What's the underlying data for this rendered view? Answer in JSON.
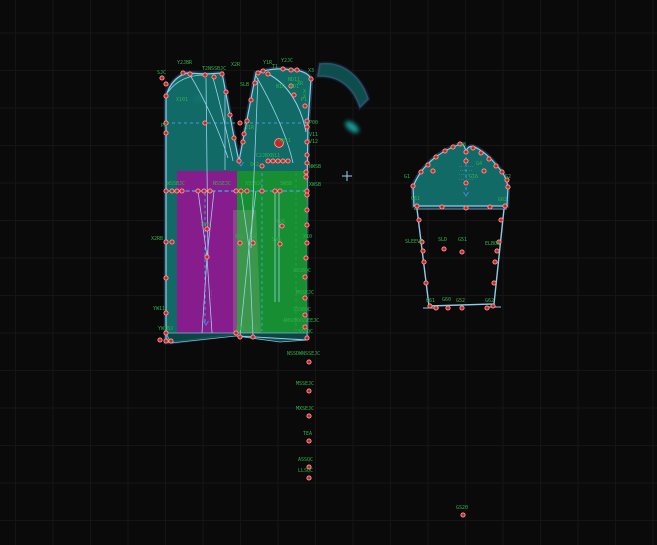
{
  "app": {
    "type": "pattern-drafting-canvas"
  },
  "canvas": {
    "width": 657,
    "height": 545,
    "background": "#0a0a0a",
    "grid": {
      "spacing": 37.5,
      "offset_x": 15.5,
      "offset_y": 33,
      "color": "#151515"
    }
  },
  "colors": {
    "piece_teal": "#12706c",
    "piece_magenta": "#8e188e",
    "piece_green": "#17912c",
    "overlap_sage": "rgba(160,175,150,0.28)",
    "hem_teal": "#0b4240",
    "outline_blue": "#8fcbe8",
    "halo_navy": "#1f3242",
    "dash_cyan": "#3f9fd8",
    "dash_green": "#2a9d44",
    "point_fill": "#c42727",
    "point_ring": "#ff9d9d",
    "label_green": "#2fb24a",
    "arrow_blue": "#4a7fe0",
    "cursor_cyan": "#8fd7f2",
    "glow_teal": "#19c2b8"
  },
  "pieces": [
    {
      "name": "bodice",
      "d": "M166,96 C170,83 177,76 187,73 L206,74 L222,73 C228,103 234,140 239,161 C243,141 250,104 256,73 L263,71 C272,69 282,68 291,70 L297,70 C304,72 309,74 311,79 L308,123 L307,191 L306,280 L307,338 L280,340 L236,334 L171,342 L166,342 Z",
      "fill": "#12706c",
      "opacity": 0.95,
      "stroke": "#8fcbe8",
      "sw": 1.2,
      "halo": "#1f3242"
    },
    {
      "name": "collar-band",
      "d": "M320,64 C343,61 361,77 368,99 L360,107 C353,86 338,75 318,76 Z",
      "fill": "#0d5250",
      "opacity": 0.95,
      "stroke": "#31506b",
      "sw": 1.6,
      "halo": "#101c29"
    },
    {
      "name": "grade-magenta",
      "d": "M177,171 L237,171 L237,333 L177,333 Z",
      "fill": "#8e188e",
      "opacity": 0.95
    },
    {
      "name": "grade-green",
      "d": "M237,171 L307,171 L307,333 L237,333 Z",
      "fill": "#17912c",
      "opacity": 0.92
    },
    {
      "name": "grade-overlap",
      "d": "M233,210 L256,210 L261,333 L233,333 Z",
      "fill": "rgba(160,175,150,0.28)"
    },
    {
      "name": "hem-strip",
      "d": "M166,333 L307,333 L307,340 L280,342 L236,336 L171,343 Z",
      "fill": "#0b4240",
      "opacity": 0.9,
      "stroke": "#7fb8da",
      "sw": 0.8
    },
    {
      "name": "sleeve-cap",
      "d": "M413,187 C417,176 424,167 432,160 C440,153 450,148 458,145 C462,143 464,144 466,151 C469,144 474,146 480,150 C488,155 496,164 502,172 C505,176 507,182 508,187 L507,206 L414,206 Z",
      "fill": "#12706c",
      "opacity": 0.95,
      "stroke": "#8fcbe8",
      "sw": 1.2,
      "halo": "#1f3242"
    },
    {
      "name": "sleeve-body",
      "d": "M417,209 L429,306 L494,304 L504,209",
      "fill": "none",
      "stroke": "#8fcbe8",
      "sw": 1.4
    }
  ],
  "lines": [
    {
      "d": "M166,123 H308",
      "c": "#3f9fd8",
      "w": 1,
      "da": "3,3"
    },
    {
      "d": "M166,191 H307",
      "c": "#3f9fd8",
      "w": 1.6,
      "da": "4,2.5"
    },
    {
      "d": "M205,193 V322",
      "c": "#3f9fd8",
      "w": 1,
      "da": "3,3"
    },
    {
      "d": "M262,173 V331",
      "c": "#3f9fd8",
      "w": 1,
      "da": "3,3"
    },
    {
      "d": "M296,173 V331",
      "c": "#2a9d44",
      "w": 1,
      "da": "3,3"
    },
    {
      "d": "M466,157 V193",
      "c": "#3f9fd8",
      "w": 1,
      "da": "3,3"
    },
    {
      "d": "M225,95 V170",
      "c": "#9ad1ea",
      "w": 0.8
    },
    {
      "d": "M206,78 L208,257",
      "c": "#9ad1ea",
      "w": 0.8
    },
    {
      "d": "M258,78 L251,248",
      "c": "#9ad1ea",
      "w": 0.8
    },
    {
      "d": "M198,191 L207,257",
      "c": "#9ad1ea",
      "w": 0.8
    },
    {
      "d": "M214,191 L207,257",
      "c": "#9ad1ea",
      "w": 0.8
    },
    {
      "d": "M207,257 L202,333",
      "c": "#9ad1ea",
      "w": 0.8
    },
    {
      "d": "M207,257 L212,333",
      "c": "#9ad1ea",
      "w": 0.8
    },
    {
      "d": "M241,191 L249,247",
      "c": "#9ad1ea",
      "w": 0.8
    },
    {
      "d": "M256,191 L249,247",
      "c": "#9ad1ea",
      "w": 0.8
    },
    {
      "d": "M249,247 L240,336",
      "c": "#9ad1ea",
      "w": 0.8
    },
    {
      "d": "M249,247 L253,336",
      "c": "#9ad1ea",
      "w": 0.8
    },
    {
      "d": "M275,191 V302",
      "c": "#9ad1ea",
      "w": 0.8
    },
    {
      "d": "M279,191 V302",
      "c": "#9ad1ea",
      "w": 0.8
    },
    {
      "d": "M268,74 C288,84 301,106 306,132",
      "c": "#9ad1ea",
      "w": 1
    },
    {
      "d": "M256,76 C270,100 287,135 293,163",
      "c": "#9ad1ea",
      "w": 0.8
    },
    {
      "d": "M190,75 C204,98 219,130 228,158",
      "c": "#9ad1ea",
      "w": 0.8
    },
    {
      "d": "M213,78 C221,106 228,138 233,161",
      "c": "#9ad1ea",
      "w": 0.8
    },
    {
      "d": "M168,92 C177,80 190,75 204,75",
      "c": "#9ad1ea",
      "w": 0.8
    },
    {
      "d": "M237,336 L307,340",
      "c": "#9ad1ea",
      "w": 0.9
    },
    {
      "d": "M413,206 H508",
      "c": "#8fcbe8",
      "w": 1.1
    },
    {
      "d": "M414,209 H507",
      "c": "#8fcbe8",
      "w": 0.8
    },
    {
      "d": "M423,308 H439",
      "c": "#8fcbe8",
      "w": 1
    },
    {
      "d": "M485,307 H501",
      "c": "#8fcbe8",
      "w": 1
    }
  ],
  "points": [
    [
      162,
      78
    ],
    [
      166,
      84
    ],
    [
      166,
      96
    ],
    [
      166,
      123
    ],
    [
      166,
      133
    ],
    [
      166,
      191
    ],
    [
      166,
      242
    ],
    [
      166,
      278
    ],
    [
      166,
      313
    ],
    [
      166,
      333
    ],
    [
      166,
      341
    ],
    [
      183,
      73
    ],
    [
      190,
      74
    ],
    [
      205,
      75
    ],
    [
      214,
      77
    ],
    [
      222,
      74
    ],
    [
      258,
      73
    ],
    [
      263,
      71
    ],
    [
      268,
      74
    ],
    [
      283,
      69
    ],
    [
      291,
      70
    ],
    [
      297,
      70
    ],
    [
      311,
      79
    ],
    [
      226,
      92
    ],
    [
      230,
      115
    ],
    [
      234,
      138
    ],
    [
      239,
      161
    ],
    [
      243,
      142
    ],
    [
      247,
      121
    ],
    [
      251,
      100
    ],
    [
      255,
      83
    ],
    [
      291,
      86
    ],
    [
      294,
      95
    ],
    [
      305,
      106
    ],
    [
      307,
      121
    ],
    [
      307,
      127
    ],
    [
      307,
      142
    ],
    [
      307,
      155
    ],
    [
      307,
      163
    ],
    [
      306,
      172
    ],
    [
      306,
      177
    ],
    [
      307,
      195
    ],
    [
      307,
      210
    ],
    [
      307,
      225
    ],
    [
      307,
      243
    ],
    [
      306,
      258
    ],
    [
      305,
      277
    ],
    [
      305,
      298
    ],
    [
      305,
      315
    ],
    [
      305,
      327
    ],
    [
      307,
      338
    ],
    [
      240,
      123
    ],
    [
      205,
      123
    ],
    [
      279,
      143,
      1
    ],
    [
      268,
      161
    ],
    [
      273,
      161
    ],
    [
      278,
      161
    ],
    [
      283,
      161
    ],
    [
      288,
      161
    ],
    [
      262,
      166
    ],
    [
      244,
      134
    ],
    [
      172,
      191
    ],
    [
      177,
      191
    ],
    [
      182,
      191
    ],
    [
      198,
      191
    ],
    [
      204,
      191
    ],
    [
      210,
      191
    ],
    [
      236,
      191
    ],
    [
      241,
      191
    ],
    [
      247,
      191
    ],
    [
      262,
      191
    ],
    [
      275,
      191
    ],
    [
      280,
      191
    ],
    [
      307,
      191
    ],
    [
      207,
      229
    ],
    [
      207,
      257
    ],
    [
      282,
      226
    ],
    [
      280,
      244
    ],
    [
      240,
      243
    ],
    [
      253,
      243
    ],
    [
      172,
      242
    ],
    [
      160,
      340
    ],
    [
      171,
      341
    ],
    [
      236,
      333
    ],
    [
      240,
      337
    ],
    [
      253,
      337
    ],
    [
      309,
      362
    ],
    [
      309,
      391
    ],
    [
      309,
      416
    ],
    [
      309,
      441
    ],
    [
      309,
      467
    ],
    [
      309,
      478
    ],
    [
      463,
      515
    ],
    [
      413,
      186
    ],
    [
      421,
      172
    ],
    [
      428,
      165
    ],
    [
      433,
      171
    ],
    [
      436,
      157
    ],
    [
      445,
      151
    ],
    [
      453,
      147
    ],
    [
      460,
      144
    ],
    [
      466,
      152
    ],
    [
      473,
      148
    ],
    [
      481,
      153
    ],
    [
      484,
      171
    ],
    [
      489,
      159
    ],
    [
      496,
      166
    ],
    [
      502,
      172
    ],
    [
      507,
      180
    ],
    [
      508,
      187
    ],
    [
      417,
      206
    ],
    [
      442,
      207
    ],
    [
      466,
      208
    ],
    [
      490,
      207
    ],
    [
      505,
      206
    ],
    [
      466,
      161
    ],
    [
      466,
      183
    ],
    [
      419,
      220
    ],
    [
      422,
      242
    ],
    [
      423,
      251
    ],
    [
      424,
      262
    ],
    [
      426,
      283
    ],
    [
      501,
      220
    ],
    [
      499,
      242
    ],
    [
      497,
      251
    ],
    [
      495,
      262
    ],
    [
      494,
      283
    ],
    [
      444,
      249
    ],
    [
      462,
      252
    ],
    [
      430,
      306
    ],
    [
      436,
      308
    ],
    [
      448,
      308
    ],
    [
      462,
      308
    ],
    [
      487,
      308
    ],
    [
      493,
      306
    ]
  ],
  "labels": [
    {
      "t": "SJC",
      "x": 157,
      "y": 74
    },
    {
      "t": "Y2JBR",
      "x": 177,
      "y": 64
    },
    {
      "t": "T2NSSBJC",
      "x": 202,
      "y": 70
    },
    {
      "t": "X2R",
      "x": 231,
      "y": 66
    },
    {
      "t": "SLB",
      "x": 240,
      "y": 86
    },
    {
      "t": "Y1R",
      "x": 263,
      "y": 64
    },
    {
      "t": "T1",
      "x": 272,
      "y": 68
    },
    {
      "t": "Y2JC",
      "x": 281,
      "y": 62
    },
    {
      "t": "X3",
      "x": 308,
      "y": 72
    },
    {
      "t": "ND11",
      "x": 288,
      "y": 81
    },
    {
      "t": "N1R",
      "x": 276,
      "y": 88
    },
    {
      "t": "ND1",
      "x": 290,
      "y": 88
    },
    {
      "t": "XR",
      "x": 297,
      "y": 85
    },
    {
      "t": "X",
      "x": 303,
      "y": 93
    },
    {
      "t": "X",
      "x": 303,
      "y": 98
    },
    {
      "t": "P1",
      "x": 301,
      "y": 101
    },
    {
      "t": "X101",
      "x": 176,
      "y": 101
    },
    {
      "t": "P6",
      "x": 161,
      "y": 127
    },
    {
      "t": "V1R",
      "x": 245,
      "y": 129
    },
    {
      "t": "XB11",
      "x": 279,
      "y": 142
    },
    {
      "t": "C2JBXB11",
      "x": 256,
      "y": 157
    },
    {
      "t": "SC2",
      "x": 250,
      "y": 166
    },
    {
      "t": "P00",
      "x": 309,
      "y": 124
    },
    {
      "t": "V11",
      "x": 309,
      "y": 136
    },
    {
      "t": "V12",
      "x": 309,
      "y": 143
    },
    {
      "t": "NWSB",
      "x": 309,
      "y": 168
    },
    {
      "t": "XWSB",
      "x": 309,
      "y": 186
    },
    {
      "t": "X10",
      "x": 303,
      "y": 238
    },
    {
      "t": "WSSBJC",
      "x": 167,
      "y": 185
    },
    {
      "t": "NSSEJC",
      "x": 213,
      "y": 185
    },
    {
      "t": "XSSBJC",
      "x": 245,
      "y": 185
    },
    {
      "t": "SWSB",
      "x": 280,
      "y": 185
    },
    {
      "t": "WV6",
      "x": 201,
      "y": 226
    },
    {
      "t": "YV6",
      "x": 276,
      "y": 223
    },
    {
      "t": "SW6",
      "x": 272,
      "y": 241
    },
    {
      "t": "XS1",
      "x": 235,
      "y": 238
    },
    {
      "t": "XS2",
      "x": 248,
      "y": 238
    },
    {
      "t": "X2RB",
      "x": 151,
      "y": 240
    },
    {
      "t": "YW11",
      "x": 153,
      "y": 310
    },
    {
      "t": "YW1BJ",
      "x": 158,
      "y": 330
    },
    {
      "t": "X11",
      "x": 236,
      "y": 330
    },
    {
      "t": "X12",
      "x": 249,
      "y": 330
    },
    {
      "t": "XSSBQC",
      "x": 293,
      "y": 272
    },
    {
      "t": "MSSEJC",
      "x": 296,
      "y": 294
    },
    {
      "t": "SSSBQC",
      "x": 293,
      "y": 311
    },
    {
      "t": "ANSQWXSSEEJC",
      "x": 283,
      "y": 322
    },
    {
      "t": "SSSQC",
      "x": 298,
      "y": 333
    },
    {
      "t": "NSSDWNSSEJC",
      "x": 287,
      "y": 355
    },
    {
      "t": "MSSEJC",
      "x": 296,
      "y": 385
    },
    {
      "t": "MXSEJC",
      "x": 296,
      "y": 410
    },
    {
      "t": "TEA",
      "x": 303,
      "y": 435
    },
    {
      "t": "ASSQC",
      "x": 298,
      "y": 461
    },
    {
      "t": "LLSQC",
      "x": 298,
      "y": 472
    },
    {
      "t": "GS20",
      "x": 456,
      "y": 509
    },
    {
      "t": "G8",
      "x": 460,
      "y": 146
    },
    {
      "t": "G1",
      "x": 404,
      "y": 178
    },
    {
      "t": "G2",
      "x": 505,
      "y": 178
    },
    {
      "t": "G4",
      "x": 476,
      "y": 165
    },
    {
      "t": "G16",
      "x": 469,
      "y": 178
    },
    {
      "t": "G61",
      "x": 411,
      "y": 200
    },
    {
      "t": "G62",
      "x": 498,
      "y": 201
    },
    {
      "t": "SLEEVE",
      "x": 405,
      "y": 243
    },
    {
      "t": "SLD",
      "x": 438,
      "y": 241
    },
    {
      "t": "G51",
      "x": 458,
      "y": 241
    },
    {
      "t": "ELBOW",
      "x": 485,
      "y": 245
    },
    {
      "t": "G61",
      "x": 426,
      "y": 302
    },
    {
      "t": "G60",
      "x": 442,
      "y": 301
    },
    {
      "t": "G52",
      "x": 456,
      "y": 302
    },
    {
      "t": "G62",
      "x": 485,
      "y": 302
    }
  ],
  "micro_text": [
    {
      "t": "·· ·····",
      "x": 466,
      "y": 167,
      "rot": 0,
      "c": "#b9d8d4",
      "s": 3
    },
    {
      "t": "···· ··",
      "x": 466,
      "y": 171,
      "rot": 0,
      "c": "#b9d8d4",
      "s": 3
    },
    {
      "t": "········",
      "x": 466,
      "y": 175,
      "rot": 0,
      "c": "#b9d8d4",
      "s": 3
    },
    {
      "t": "··· ····",
      "x": 466,
      "y": 180,
      "rot": 0,
      "c": "#b9d8d4",
      "s": 3
    },
    {
      "t": "·······",
      "x": 434,
      "y": 168,
      "rot": -40,
      "c": "#2fb24a",
      "s": 3
    },
    {
      "t": "·······",
      "x": 497,
      "y": 167,
      "rot": 40,
      "c": "#2fb24a",
      "s": 3
    },
    {
      "t": "·········",
      "x": 251,
      "y": 278,
      "rot": -90,
      "c": "#38c257",
      "s": 3
    },
    {
      "t": "·········",
      "x": 255,
      "y": 278,
      "rot": -90,
      "c": "#38c257",
      "s": 3
    },
    {
      "t": "·········",
      "x": 259,
      "y": 278,
      "rot": -90,
      "c": "#38c257",
      "s": 3
    },
    {
      "t": "······",
      "x": 212,
      "y": 295,
      "rot": -90,
      "c": "#c9b7e4",
      "s": 3
    }
  ],
  "arrows": [
    [
      206,
      325
    ],
    [
      466,
      196
    ],
    [
      241,
      166
    ]
  ],
  "glows": [
    {
      "x": 200,
      "y": 98,
      "rx": 7,
      "ry": 3.5,
      "rot": -25
    },
    {
      "x": 352,
      "y": 127,
      "rx": 8,
      "ry": 4,
      "rot": 38
    }
  ],
  "cursor": {
    "x": 347,
    "y": 176
  }
}
